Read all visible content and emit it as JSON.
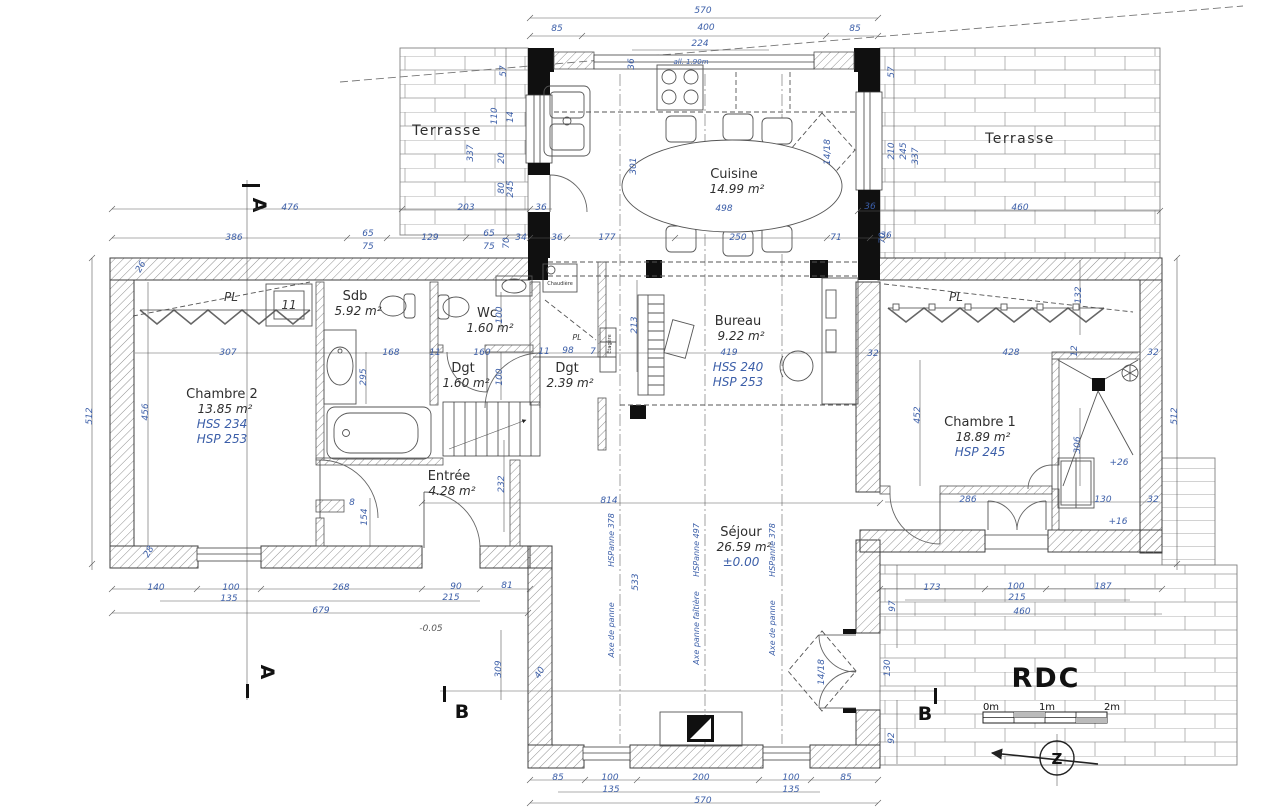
{
  "title": "RDC",
  "sections": {
    "a": "A",
    "b": "B"
  },
  "north": {
    "letter": "Z"
  },
  "scalebar": {
    "m0": "0m",
    "m1": "1m",
    "m2": "2m"
  },
  "colors": {
    "dimension_blue": "#3b5ea8",
    "line_gray": "#3f3f3f",
    "column_black": "#101010"
  },
  "rooms": [
    {
      "name": "Terrasse",
      "x": 447,
      "y": 135,
      "cls": "tname"
    },
    {
      "name": "Terrasse",
      "x": 1020,
      "y": 143,
      "cls": "tname"
    },
    {
      "name": "Cuisine",
      "area": "14.99 m²",
      "x": 734,
      "y": 178
    },
    {
      "name": "Chambre 2",
      "area": "13.85 m²",
      "extra": [
        "HSS 234",
        "HSP 253"
      ],
      "x": 222,
      "y": 398
    },
    {
      "name": "Sdb",
      "area": "5.92 m²",
      "x": 355,
      "y": 300
    },
    {
      "name": "Wc",
      "area": "1.60 m²",
      "x": 487,
      "y": 317
    },
    {
      "name": "Dgt",
      "area": "1.60 m²",
      "x": 463,
      "y": 372
    },
    {
      "name": "Dgt",
      "area": "2.39 m²",
      "x": 567,
      "y": 372
    },
    {
      "name": "Bureau",
      "area": "9.22 m²",
      "extra": [
        "HSS 240",
        "HSP 253"
      ],
      "x": 738,
      "y": 325,
      "gap": true
    },
    {
      "name": "Chambre 1",
      "area": "18.89 m²",
      "extra": [
        "HSP 245"
      ],
      "x": 980,
      "y": 426
    },
    {
      "name": "Entrée",
      "area": "4.28 m²",
      "x": 449,
      "y": 480
    },
    {
      "name": "Séjour",
      "area": "26.59 m²",
      "extra": [
        "±0.00"
      ],
      "x": 741,
      "y": 536
    }
  ],
  "annotations": [
    {
      "t": "PL",
      "x": 231,
      "y": 301,
      "cls": "pl"
    },
    {
      "t": "PL",
      "x": 956,
      "y": 301,
      "cls": "pl"
    },
    {
      "t": "PL",
      "x": 577,
      "y": 340,
      "cls": "plS"
    },
    {
      "t": "11",
      "x": 289,
      "y": 309,
      "cls": "pl"
    },
    {
      "t": "Chaudière",
      "x": 560,
      "y": 285,
      "cls": "micro"
    },
    {
      "t": "Étagère",
      "x": 611,
      "y": 344,
      "r": -90,
      "cls": "micro"
    },
    {
      "t": "all. 1.90m",
      "x": 691,
      "y": 64,
      "cls": "microB"
    },
    {
      "t": "HSPanne 378",
      "x": 614,
      "y": 540,
      "r": -90,
      "cls": "axis"
    },
    {
      "t": "Axe de panne",
      "x": 614,
      "y": 630,
      "r": -90,
      "cls": "axis"
    },
    {
      "t": "HSPanne 497",
      "x": 699,
      "y": 550,
      "r": -90,
      "cls": "axis"
    },
    {
      "t": "Axe panne faîtière",
      "x": 699,
      "y": 628,
      "r": -90,
      "cls": "axis"
    },
    {
      "t": "HSPanne 378",
      "x": 775,
      "y": 550,
      "r": -90,
      "cls": "axis"
    },
    {
      "t": "Axe de panne",
      "x": 775,
      "y": 628,
      "r": -90,
      "cls": "axis"
    }
  ],
  "dims": [
    {
      "t": "570",
      "x": 703,
      "y": 13
    },
    {
      "t": "85",
      "x": 557,
      "y": 31
    },
    {
      "t": "400",
      "x": 706,
      "y": 30
    },
    {
      "t": "85",
      "x": 855,
      "y": 31
    },
    {
      "t": "224",
      "x": 700,
      "y": 46
    },
    {
      "t": "36",
      "x": 634,
      "y": 64,
      "r": -90
    },
    {
      "t": "301",
      "x": 636,
      "y": 166,
      "r": -90
    },
    {
      "t": "498",
      "x": 724,
      "y": 211
    },
    {
      "t": "14/18",
      "x": 830,
      "y": 152,
      "r": -90
    },
    {
      "t": "57",
      "x": 506,
      "y": 71,
      "r": -90
    },
    {
      "t": "337",
      "x": 473,
      "y": 153,
      "r": -90
    },
    {
      "t": "110",
      "x": 497,
      "y": 116,
      "r": -90
    },
    {
      "t": "14",
      "x": 513,
      "y": 117,
      "r": -90
    },
    {
      "t": "20",
      "x": 504,
      "y": 158,
      "r": -90
    },
    {
      "t": "80",
      "x": 504,
      "y": 188,
      "r": -90
    },
    {
      "t": "245",
      "x": 513,
      "y": 189,
      "r": -90
    },
    {
      "t": "476",
      "x": 290,
      "y": 210
    },
    {
      "t": "203",
      "x": 466,
      "y": 210
    },
    {
      "t": "36",
      "x": 541,
      "y": 210
    },
    {
      "t": "36",
      "x": 870,
      "y": 209
    },
    {
      "t": "460",
      "x": 1020,
      "y": 210
    },
    {
      "t": "386",
      "x": 234,
      "y": 240
    },
    {
      "t": "65",
      "x": 368,
      "y": 236
    },
    {
      "t": "75",
      "x": 368,
      "y": 249
    },
    {
      "t": "129",
      "x": 430,
      "y": 240
    },
    {
      "t": "65",
      "x": 489,
      "y": 236
    },
    {
      "t": "75",
      "x": 489,
      "y": 249
    },
    {
      "t": "70",
      "x": 509,
      "y": 243,
      "r": -90
    },
    {
      "t": "34",
      "x": 521,
      "y": 240
    },
    {
      "t": "36",
      "x": 557,
      "y": 240
    },
    {
      "t": "177",
      "x": 607,
      "y": 240
    },
    {
      "t": "250",
      "x": 738,
      "y": 240
    },
    {
      "t": "71",
      "x": 836,
      "y": 240
    },
    {
      "t": "36",
      "x": 886,
      "y": 238
    },
    {
      "t": "57",
      "x": 894,
      "y": 72,
      "r": -90
    },
    {
      "t": "210",
      "x": 894,
      "y": 151,
      "r": -90
    },
    {
      "t": "245",
      "x": 906,
      "y": 151,
      "r": -90
    },
    {
      "t": "337",
      "x": 918,
      "y": 156,
      "r": -90
    },
    {
      "t": "70",
      "x": 885,
      "y": 238,
      "r": -90
    },
    {
      "t": "512",
      "x": 92,
      "y": 416,
      "r": -90
    },
    {
      "t": "456",
      "x": 148,
      "y": 412,
      "r": -90
    },
    {
      "t": "26",
      "x": 143,
      "y": 268,
      "r": -60
    },
    {
      "t": "28",
      "x": 151,
      "y": 553,
      "r": -60
    },
    {
      "t": "307",
      "x": 228,
      "y": 355
    },
    {
      "t": "168",
      "x": 391,
      "y": 355
    },
    {
      "t": "11",
      "x": 435,
      "y": 355
    },
    {
      "t": "160",
      "x": 482,
      "y": 355
    },
    {
      "t": "11",
      "x": 544,
      "y": 354
    },
    {
      "t": "98",
      "x": 568,
      "y": 353
    },
    {
      "t": "7",
      "x": 593,
      "y": 354
    },
    {
      "t": "419",
      "x": 729,
      "y": 355
    },
    {
      "t": "32",
      "x": 873,
      "y": 356
    },
    {
      "t": "428",
      "x": 1011,
      "y": 355
    },
    {
      "t": "12",
      "x": 1077,
      "y": 351,
      "r": -90
    },
    {
      "t": "32",
      "x": 1153,
      "y": 355
    },
    {
      "t": "295",
      "x": 366,
      "y": 377,
      "r": -90
    },
    {
      "t": "100",
      "x": 502,
      "y": 315,
      "r": -90
    },
    {
      "t": "100",
      "x": 502,
      "y": 377,
      "r": -90
    },
    {
      "t": "232",
      "x": 504,
      "y": 484,
      "r": -90
    },
    {
      "t": "213",
      "x": 637,
      "y": 325,
      "r": -90
    },
    {
      "t": "154",
      "x": 367,
      "y": 517,
      "r": -90
    },
    {
      "t": "8",
      "x": 352,
      "y": 505
    },
    {
      "t": "132",
      "x": 1081,
      "y": 295,
      "r": -90
    },
    {
      "t": "452",
      "x": 920,
      "y": 415,
      "r": -90
    },
    {
      "t": "306",
      "x": 1080,
      "y": 445,
      "r": -90
    },
    {
      "t": "512",
      "x": 1177,
      "y": 416,
      "r": -90
    },
    {
      "t": "+26",
      "x": 1119,
      "y": 465
    },
    {
      "t": "+16",
      "x": 1118,
      "y": 524
    },
    {
      "t": "-0.05",
      "x": 431,
      "y": 631,
      "cls": "lvl"
    },
    {
      "t": "286",
      "x": 968,
      "y": 502
    },
    {
      "t": "130",
      "x": 1103,
      "y": 502
    },
    {
      "t": "32",
      "x": 1153,
      "y": 502
    },
    {
      "t": "814",
      "x": 609,
      "y": 503
    },
    {
      "t": "140",
      "x": 156,
      "y": 590
    },
    {
      "t": "100",
      "x": 231,
      "y": 590
    },
    {
      "t": "135",
      "x": 229,
      "y": 601
    },
    {
      "t": "268",
      "x": 341,
      "y": 590
    },
    {
      "t": "90",
      "x": 456,
      "y": 589
    },
    {
      "t": "215",
      "x": 451,
      "y": 600
    },
    {
      "t": "81",
      "x": 507,
      "y": 588
    },
    {
      "t": "679",
      "x": 321,
      "y": 613
    },
    {
      "t": "533",
      "x": 638,
      "y": 582,
      "r": -90
    },
    {
      "t": "309",
      "x": 501,
      "y": 669,
      "r": -90
    },
    {
      "t": "40",
      "x": 542,
      "y": 674,
      "r": -60
    },
    {
      "t": "92",
      "x": 894,
      "y": 738,
      "r": -90
    },
    {
      "t": "130",
      "x": 890,
      "y": 668,
      "r": -90
    },
    {
      "t": "14/18",
      "x": 824,
      "y": 672,
      "r": -90
    },
    {
      "t": "85",
      "x": 558,
      "y": 780
    },
    {
      "t": "100",
      "x": 610,
      "y": 780
    },
    {
      "t": "135",
      "x": 611,
      "y": 792
    },
    {
      "t": "200",
      "x": 701,
      "y": 780
    },
    {
      "t": "100",
      "x": 791,
      "y": 780
    },
    {
      "t": "135",
      "x": 791,
      "y": 792
    },
    {
      "t": "85",
      "x": 846,
      "y": 780
    },
    {
      "t": "570",
      "x": 703,
      "y": 803
    },
    {
      "t": "173",
      "x": 932,
      "y": 590
    },
    {
      "t": "100",
      "x": 1016,
      "y": 589
    },
    {
      "t": "215",
      "x": 1017,
      "y": 600
    },
    {
      "t": "187",
      "x": 1103,
      "y": 589
    },
    {
      "t": "460",
      "x": 1022,
      "y": 614
    },
    {
      "t": "97",
      "x": 895,
      "y": 606,
      "r": -90
    }
  ]
}
